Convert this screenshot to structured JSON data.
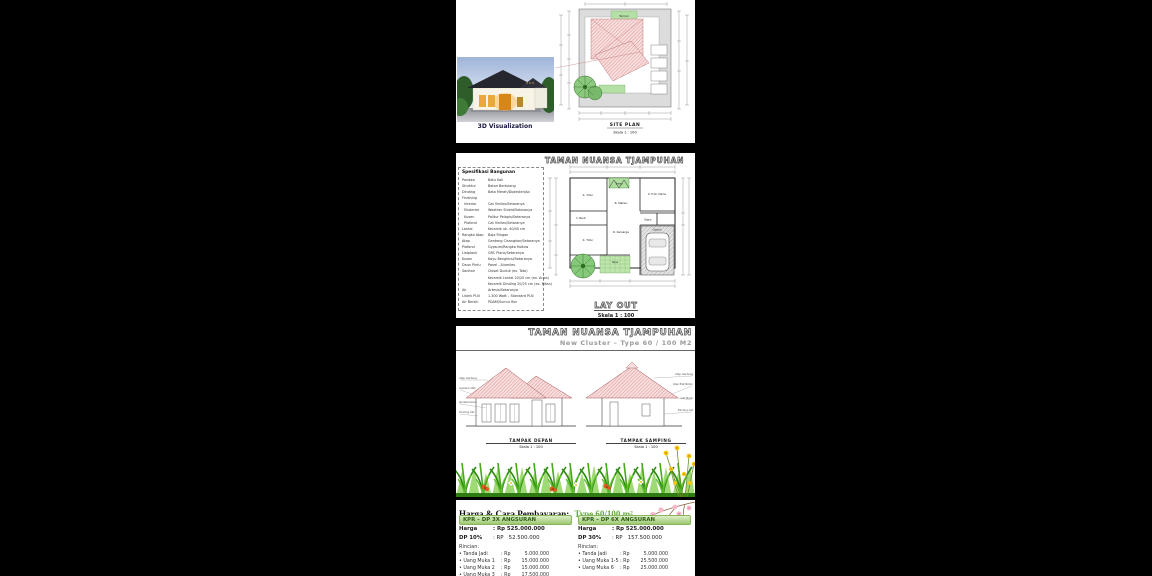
{
  "section1": {
    "photo_caption": "3D Visualization",
    "siteplan": {
      "title": "SITE PLAN",
      "scale": "Skala 1 : 100",
      "taman_label": "Taman"
    }
  },
  "section2": {
    "header": "TAMAN NUANSA TJAMPUHAN",
    "specs": {
      "title": "Spesifikasi Bangunan",
      "rows": [
        {
          "label": "Pondasi",
          "value": "Batu Kali"
        },
        {
          "label": "Struktur",
          "value": "Beton Bertulang"
        },
        {
          "label": "Dinding",
          "value": "Bata Merah/Diplester/Aci"
        },
        {
          "label": "Finishing",
          "value": ""
        },
        {
          "label": "  Interior",
          "value": "Cat Vinilex/Setaranya"
        },
        {
          "label": "  Eksterior",
          "value": "Weather Shield/Setaranya"
        },
        {
          "label": "  Kusen",
          "value": "Politur Pelapis/Setaranya"
        },
        {
          "label": "  Plafond",
          "value": "Cat Vinilex/Setaranya"
        },
        {
          "label": "Lantai",
          "value": "Keramik uk. 40/40 cm"
        },
        {
          "label": "Rangka Atap",
          "value": "Baja Ringan"
        },
        {
          "label": "Atap",
          "value": "Genteng Cisangkan/Setaranya"
        },
        {
          "label": "Plafond",
          "value": "Gypsum/Rangka Hollow"
        },
        {
          "label": "Listplank",
          "value": "GRC Plank/Setaranya"
        },
        {
          "label": "Kusen",
          "value": "Kayu Bengkirai/Setaranya"
        },
        {
          "label": "Daun Pintu",
          "value": "Panel - Alumilex"
        },
        {
          "label": "Sanitair",
          "value": "Closet Duduk (ex. Toto)"
        },
        {
          "label": "",
          "value": "Keramik Lantai 20/20 cm (ex. Arwa)"
        },
        {
          "label": "",
          "value": "Keramik Dinding 20/25 cm (ex. Milan)"
        },
        {
          "label": "Air",
          "value": "Artesis/Setaranya"
        },
        {
          "label": "Listrik PLN",
          "value": "1.300 Watt – Standard PLN"
        },
        {
          "label": "Air Bersih",
          "value": "PDAM/Sumur Bor"
        }
      ]
    },
    "floorplan": {
      "rooms": {
        "bed1": "K. Tidur",
        "taman": "Taman",
        "master": "K. Tidur Utama",
        "rmakan": "R. Makan",
        "kmandi": "K. Mandi",
        "dapur": "Dapur",
        "rkeluarga": "R. Keluarga",
        "bed2": "K. Tidur",
        "teras": "Teras",
        "carport": "Carport"
      },
      "title": "LAY OUT",
      "scale": "Skala 1 : 100"
    }
  },
  "section3": {
    "header": "TAMAN NUANSA TJAMPUHAN",
    "subtitle": "New Cluster – Type 60 / 100 M2",
    "front": {
      "label": "TAMPAK DEPAN",
      "scale": "Skala 1 : 100",
      "callouts": [
        "Atap Genteng",
        "Lisplank GRC",
        "Jendela Kaca",
        "Dinding Cat"
      ]
    },
    "side": {
      "label": "TAMPAK SAMPING",
      "scale": "Skala 1 : 100",
      "callouts": [
        "Atap Genteng",
        "Atap Plat Beton",
        "List Plank",
        "Dinding Cat"
      ]
    }
  },
  "pricing": {
    "title": "Harga & Cara Pembayaran:",
    "type_label": "Type 60/100 m²",
    "columns": [
      {
        "header": "KPR – DP 3X ANGSURAN",
        "harga_label": "Harga",
        "harga_value": ": Rp 525.000.000",
        "dp_label": "DP 10%",
        "dp_value": ": RP   52.500.000",
        "rincian_label": "Rincian:",
        "items": [
          {
            "label": "• Tanda Jadi",
            "rp": ": Rp",
            "value": "5.000.000"
          },
          {
            "label": "• Uang Muka 1",
            "rp": ": Rp",
            "value": "15.000.000"
          },
          {
            "label": "• Uang Muka 2",
            "rp": ": Rp",
            "value": "15.000.000"
          },
          {
            "label": "• Uang Muka 3",
            "rp": ": Rp",
            "value": "17.500.000"
          },
          {
            "label": "Jumlah",
            "rp": ": Rp",
            "value": "52.500.000"
          }
        ]
      },
      {
        "header": "KPR – DP 6X ANGSURAN",
        "harga_label": "Harga",
        "harga_value": ": Rp 525.000.000",
        "dp_label": "DP 30%",
        "dp_value": ": RP   157.500.000",
        "rincian_label": "Rincian:",
        "items": [
          {
            "label": "• Tanda Jadi",
            "rp": ": Rp",
            "value": "5.000.000"
          },
          {
            "label": "• Uang Muka 1-5",
            "rp": ": Rp",
            "value": "25.500.000"
          },
          {
            "label": "• Uang Muka 6",
            "rp": ": Rp",
            "value": "25.000.000"
          }
        ]
      }
    ]
  },
  "colors": {
    "roof_hatch_pink": "#dd9090",
    "plan_green": "#b5e0a5",
    "band_green": "#9cc96e",
    "type_green": "#64a93c",
    "grass_green": "#45a01c"
  }
}
